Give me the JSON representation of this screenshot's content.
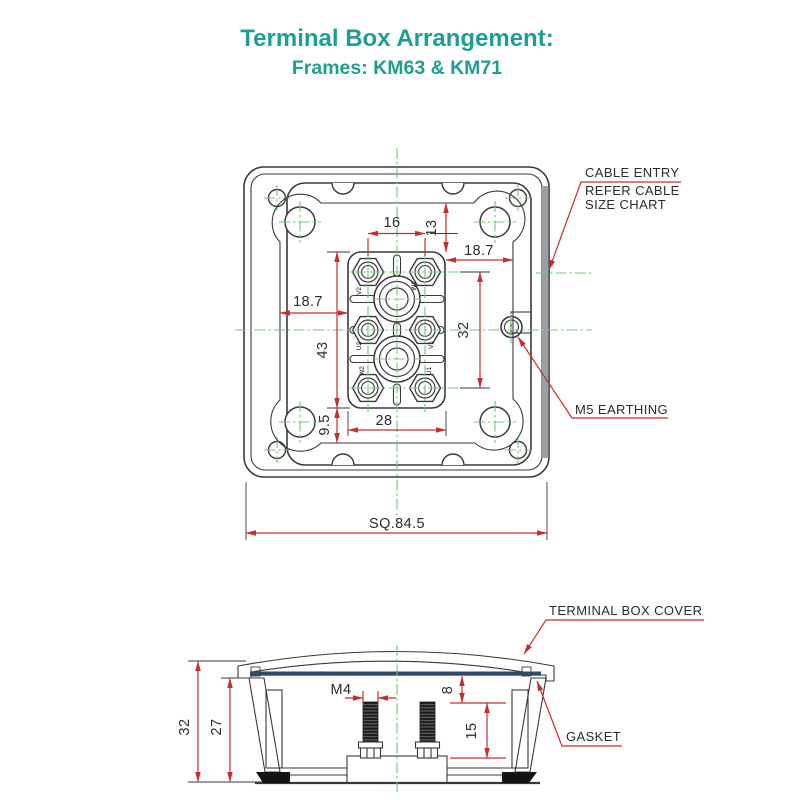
{
  "title": {
    "line1": "Terminal Box Arrangement:",
    "line2": "Frames: KM63 & KM71"
  },
  "colors": {
    "accent_teal": "#1F9E93",
    "dimension_red": "#C62F2F",
    "centerline_green": "#74C776",
    "drawing_line": "#3A3A3E",
    "gasket_blue": "#33486B",
    "gasket_highlight": "#B5E3F2",
    "cable_face_gray": "#9AA0A4"
  },
  "top_view": {
    "labels": {
      "cable_entry_line1": "CABLE ENTRY",
      "cable_entry_line2": "REFER CABLE",
      "cable_entry_line3": "SIZE CHART",
      "earthing": "M5 EARTHING"
    },
    "dims": {
      "d16": "16",
      "d13": "13",
      "d187_right": "18.7",
      "d187_left": "18.7",
      "d32": "32",
      "d43": "43",
      "d95": "9.5",
      "d28": "28",
      "square": "SQ.84.5"
    },
    "terminals": [
      "V2",
      "W1",
      "U2",
      "V1",
      "W2",
      "U1"
    ]
  },
  "side_view": {
    "labels": {
      "cover": "TERMINAL BOX COVER",
      "gasket": "GASKET"
    },
    "dims": {
      "d32": "32",
      "d27": "27",
      "m4": "M4",
      "d8": "8",
      "d15": "15"
    }
  }
}
